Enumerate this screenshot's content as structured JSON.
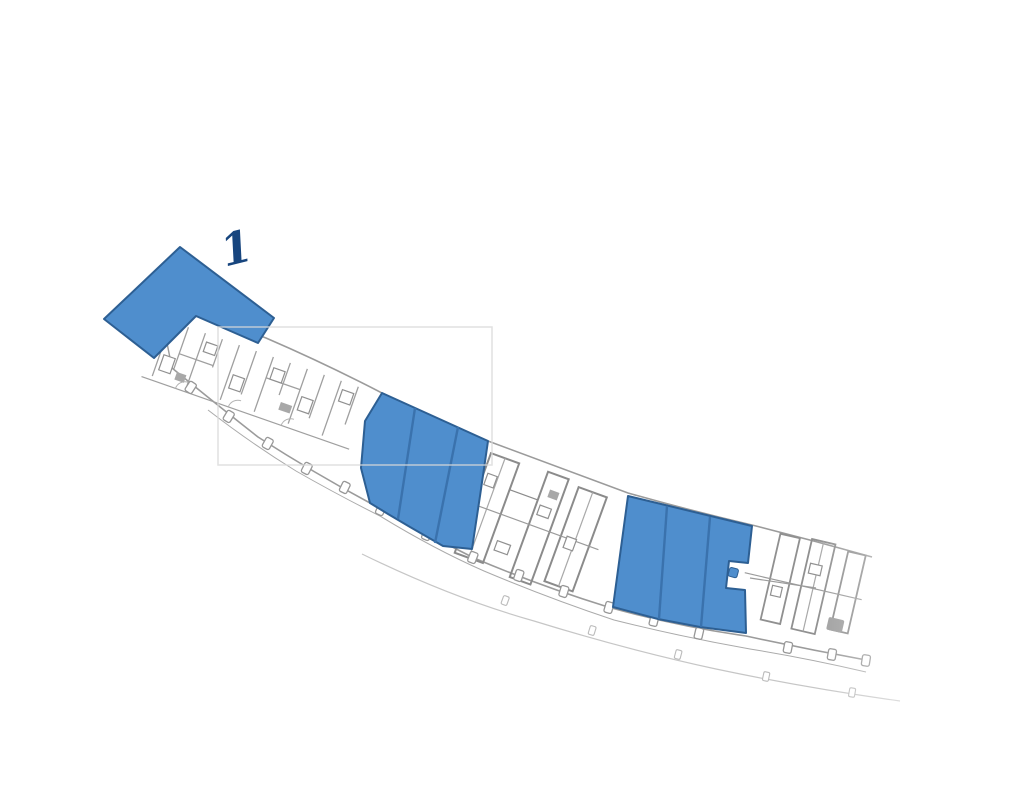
{
  "floor_plan": {
    "label": "1",
    "colors": {
      "highlight_fill": "#4f8ecd",
      "highlight_stroke": "#2d5f93",
      "pane_divider": "#3a72ad",
      "label_color": "#17457e",
      "wall_gray": "#8a8a8a",
      "watermark_gray": "#d9d9d9"
    },
    "areas": [
      {
        "id": "area-1",
        "label": "1",
        "type": "highlighted-unit",
        "panes": 1
      },
      {
        "id": "area-2",
        "label": "",
        "type": "highlighted-unit",
        "panes": 3
      },
      {
        "id": "area-3",
        "label": "",
        "type": "highlighted-unit",
        "panes": 3
      }
    ]
  }
}
